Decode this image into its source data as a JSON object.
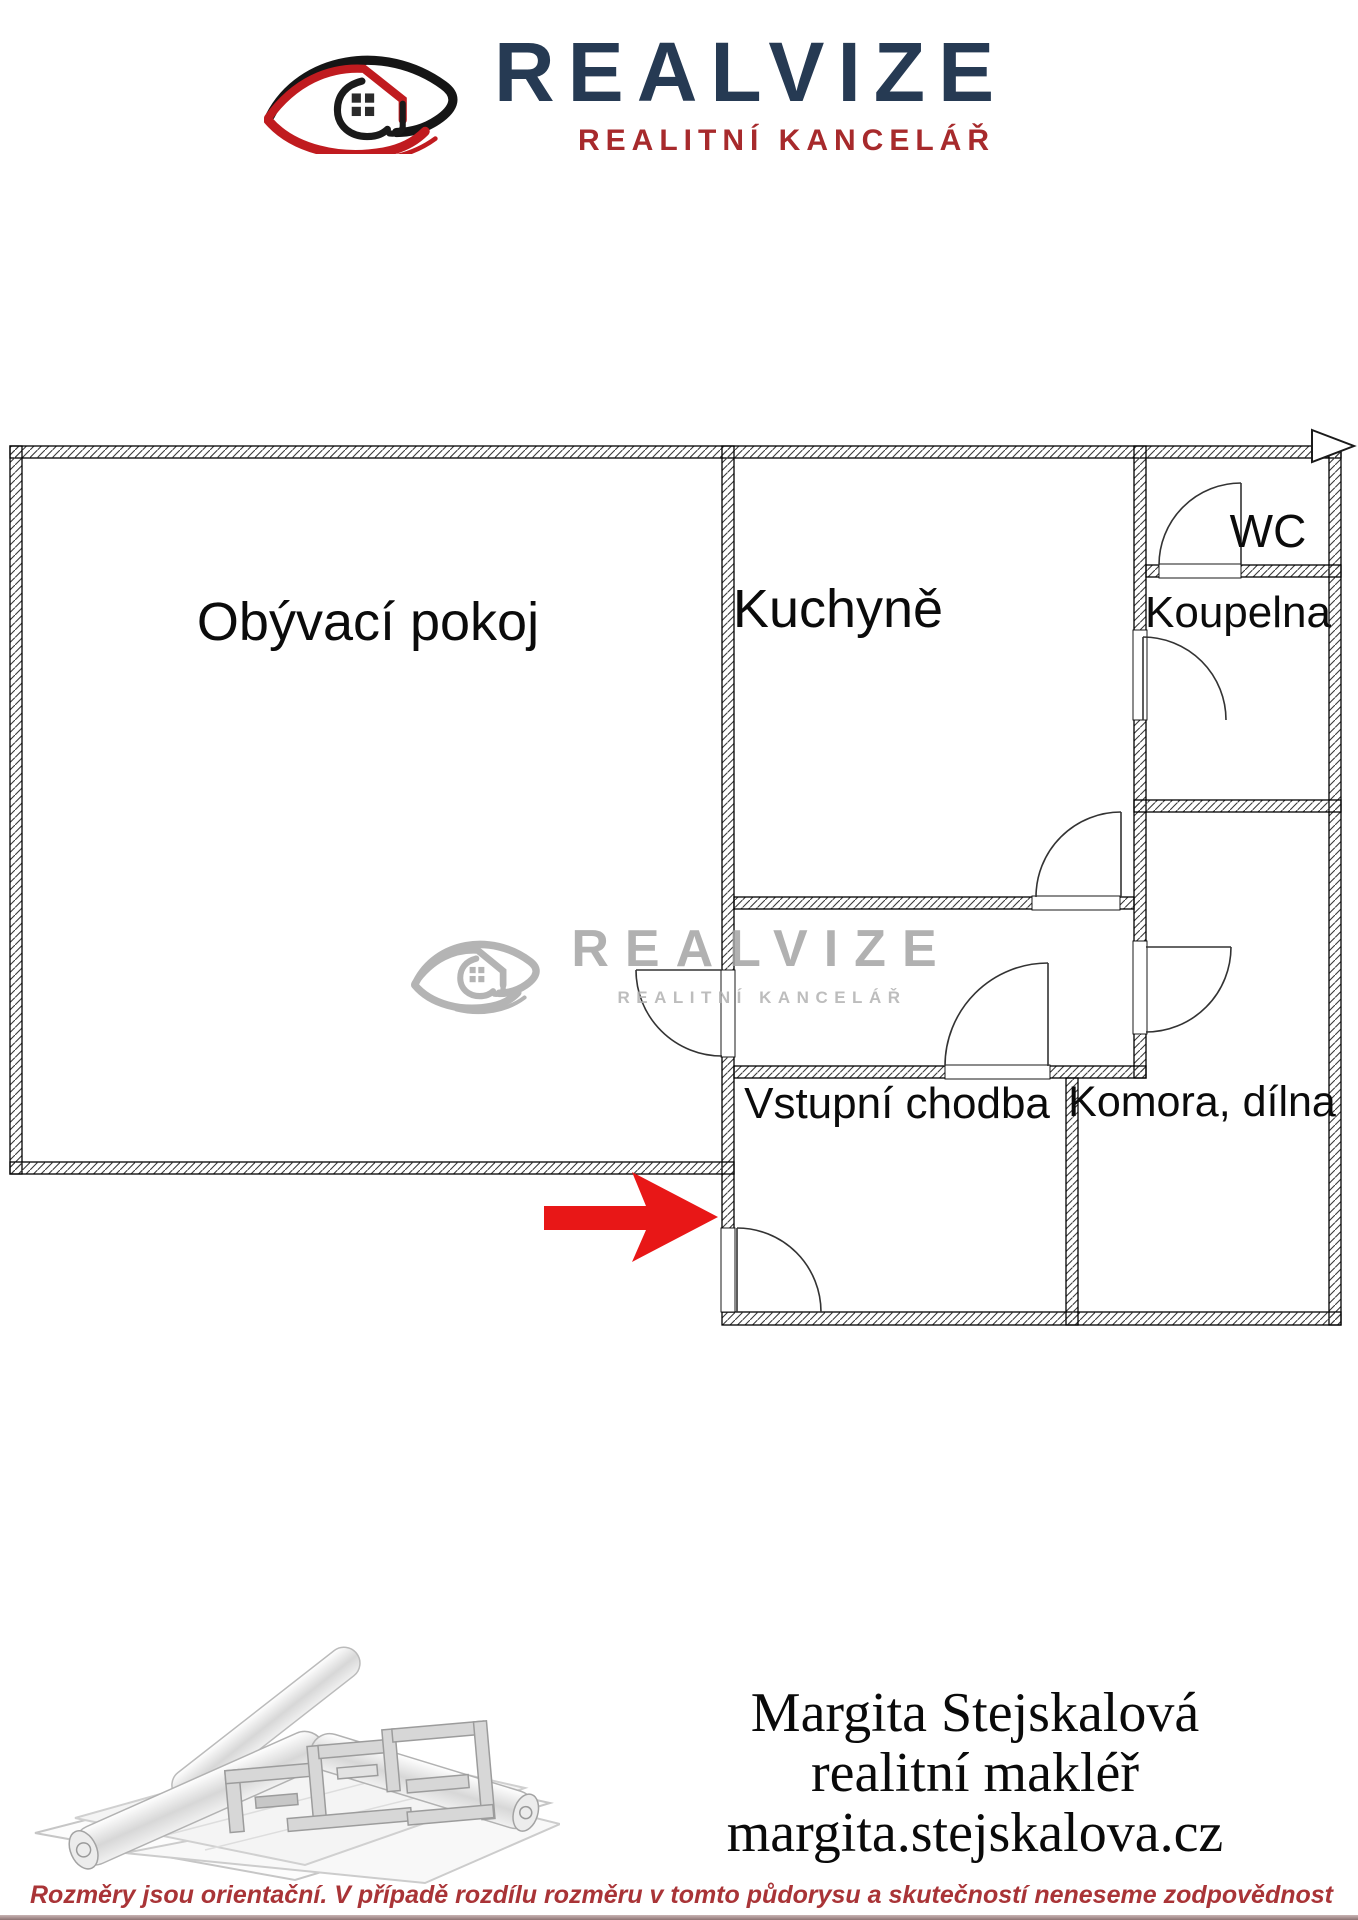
{
  "header": {
    "brand": "REALVIZE",
    "tagline": "REALITNÍ KANCELÁŘ"
  },
  "floorplan": {
    "rooms": [
      {
        "name": "living-room",
        "label": "Obývací pokoj"
      },
      {
        "name": "kitchen",
        "label": "Kuchyně"
      },
      {
        "name": "wc",
        "label": "WC"
      },
      {
        "name": "bathroom",
        "label": "Koupelna"
      },
      {
        "name": "entry-hall",
        "label": "Vstupní chodba"
      },
      {
        "name": "storage-workshop",
        "label": "Komora, dílna"
      }
    ],
    "watermark": {
      "brand": "REALVIZE",
      "tagline": "REALITNÍ KANCELÁŘ"
    },
    "colors": {
      "entrance_arrow": "#e81717",
      "wall_line": "#000000",
      "hatch": "#3a3a3a",
      "watermark_gray": "#a4a4a4"
    }
  },
  "footer": {
    "agent_name": "Margita Stejskalová",
    "agent_role": "realitní makléř",
    "agent_website": "margita.stejskalova.cz",
    "disclaimer": "Rozměry jsou orientační. V případě rozdílu rozměru v tomto půdorysu a skutečností neneseme zodpovědnost"
  },
  "brand_colors": {
    "navy": "#263a53",
    "red": "#a72a2c",
    "disclaimer_red": "#a93437"
  }
}
